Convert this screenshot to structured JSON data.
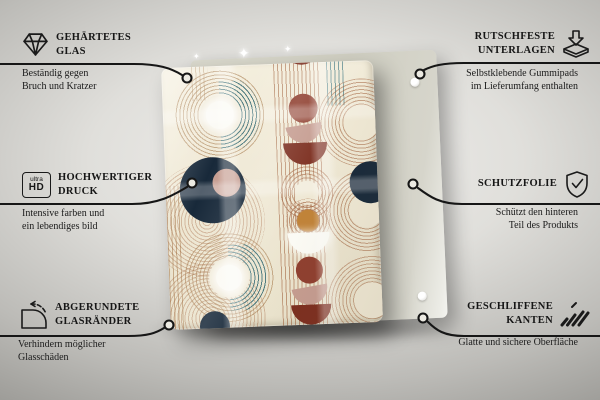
{
  "callouts": {
    "left": [
      {
        "title": "GEHÄRTETES\nGLAS",
        "desc": "Beständig gegen\nBruch und Kratzer"
      },
      {
        "title": "HOCHWERTIGER\nDRUCK",
        "desc": "Intensive farben und\nein lebendiges bild"
      },
      {
        "title": "ABGERUNDETE\nGLASRÄNDER",
        "desc": "Verhindern möglicher\nGlasschäden"
      }
    ],
    "right": [
      {
        "title": "RUTSCHFESTE\nUNTERLAGEN",
        "desc": "Selbstklebende Gummipads\nim Lieferumfang enthalten"
      },
      {
        "title": "SCHUTZFOLIE",
        "desc": "Schützt den hinteren\nTeil des Produkts"
      },
      {
        "title": "GESCHLIFFENE\nKANTEN",
        "desc": "Glatte und sichere Oberfläche"
      }
    ]
  },
  "icons": {
    "ultra_hd_top": "ultra",
    "ultra_hd_bottom": "HD",
    "sparkle_glyph": "✦"
  },
  "product": {
    "back_panel_pads_visible": 2,
    "style": "mid-century abstract arches pattern on glass panel"
  },
  "colors": {
    "cream": "#efe8d4",
    "navy": "#18293a",
    "brick": "#8f3f2f",
    "darkred": "#7c2e1f",
    "pink": "#c59c90",
    "tan": "#a97f52",
    "rust": "#9c5a34",
    "teal": "#35707c",
    "gold": "#c08339",
    "white": "#fbfaf4",
    "line": "#161616",
    "backpanel": "#d4d3c6"
  }
}
